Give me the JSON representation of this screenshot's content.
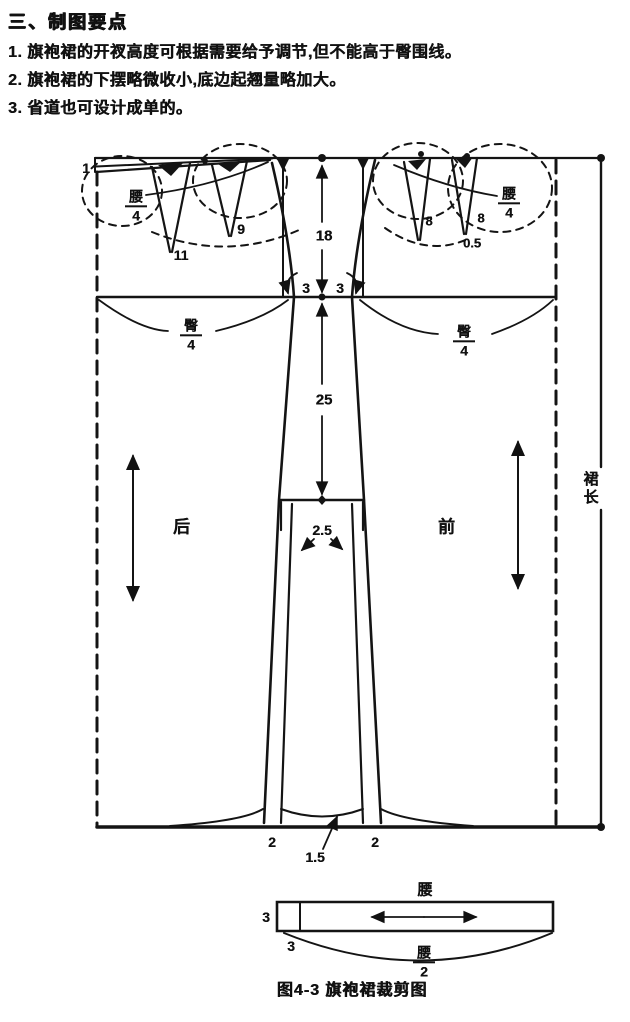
{
  "page": {
    "heading": "三、制图要点",
    "notes": [
      "1. 旗袍裙的开衩高度可根据需要给予调节,但不能高于臀围线。",
      "2. 旗袍裙的下摆略微收小,底边起翘量略加大。",
      "3. 省道也可设计成单的。"
    ],
    "caption": "图4-3  旗袍裙裁剪图"
  },
  "diagram": {
    "back": {
      "name": "后",
      "waist_frac_num": "腰",
      "waist_frac_den": "4",
      "hip_frac_num": "臀",
      "hip_frac_den": "4",
      "dart1_len": "11",
      "dart2_len": "9"
    },
    "front": {
      "name": "前",
      "waist_frac_num": "腰",
      "waist_frac_den": "4",
      "hip_frac_num": "臀",
      "hip_frac_den": "4",
      "dart1_len": "8",
      "dart2_len": "8",
      "dart_offset": "0.5"
    },
    "dims": {
      "cb_drop": "1",
      "waist_to_hip": "18",
      "hip_ease_left": "3",
      "hip_ease_right": "3",
      "hip_to_slit": "25",
      "slit_lap": "2.5",
      "hem_inset_left": "2",
      "hem_inset_right": "2",
      "hem_rise": "1.5",
      "skirt_length": "裙长"
    },
    "waistband": {
      "top_label": "腰",
      "width": "3",
      "extension": "3",
      "len_frac_num": "腰",
      "len_frac_den": "2"
    }
  }
}
